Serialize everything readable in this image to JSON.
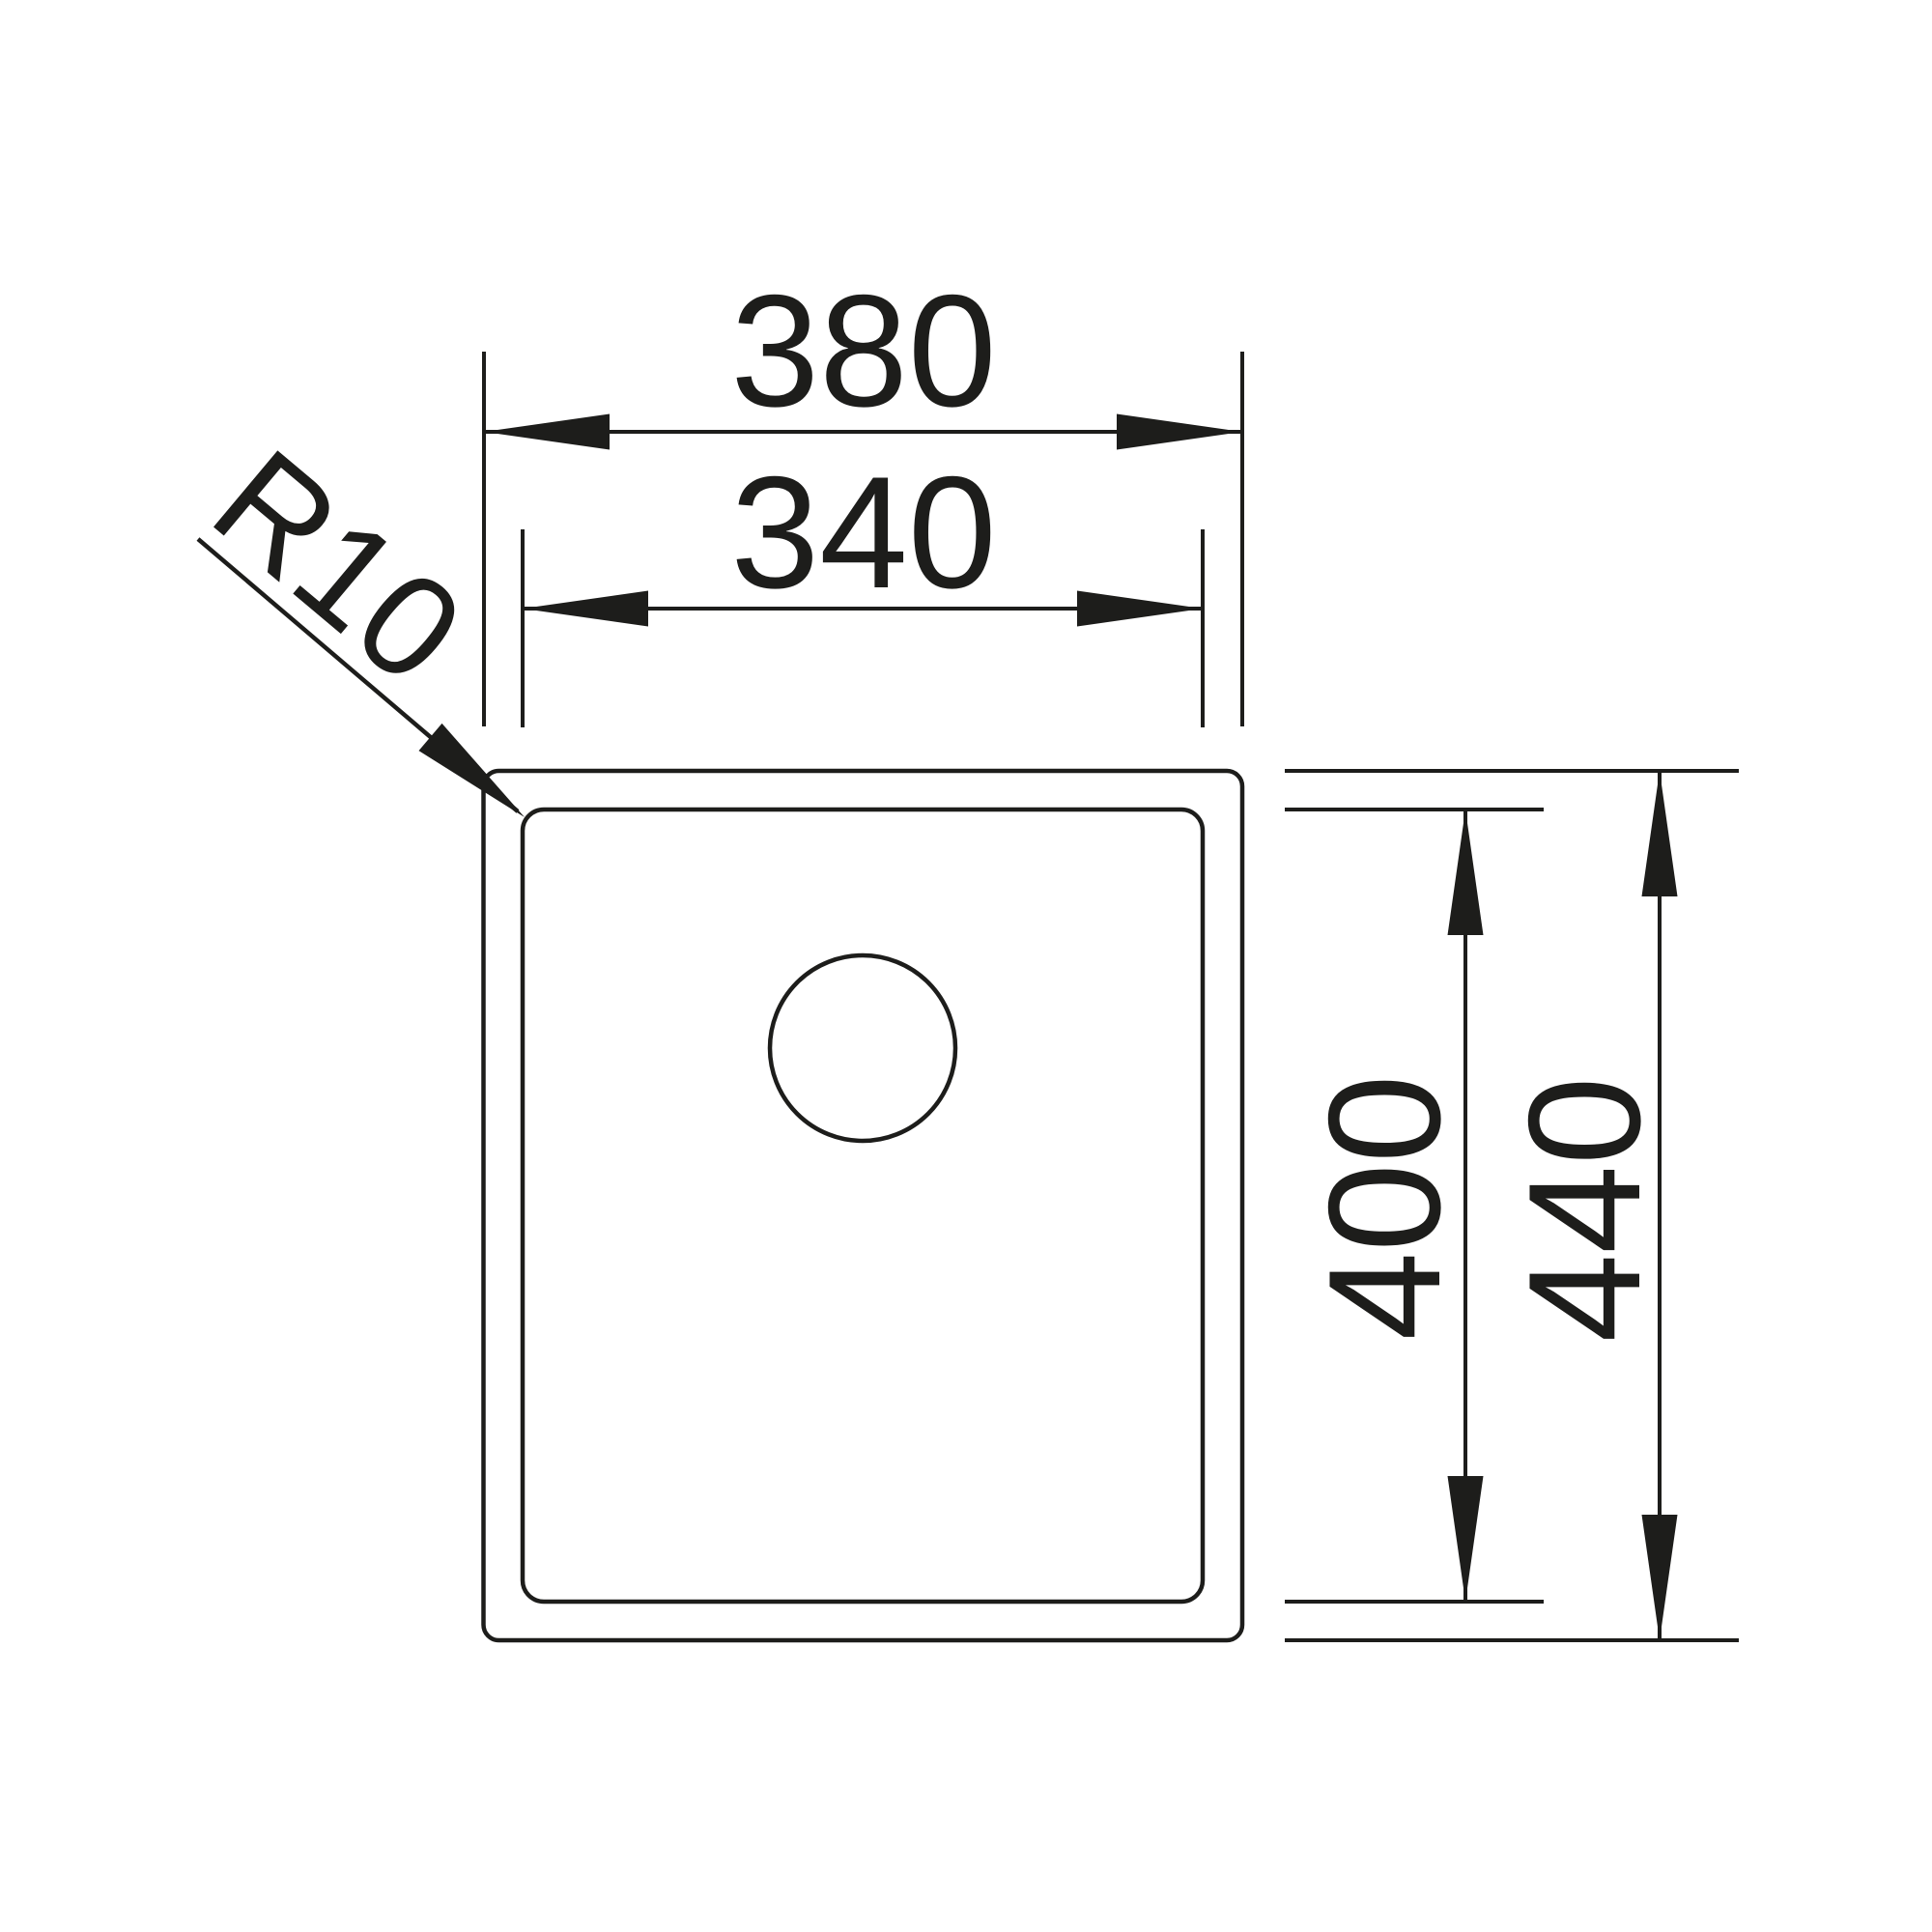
{
  "diagram": {
    "type": "sink-technical-drawing",
    "labels": {
      "outer_width": "380",
      "inner_width": "340",
      "inner_height": "400",
      "outer_height": "440",
      "corner_radius": "R10"
    },
    "colors": {
      "line": "#1d1d1b",
      "background": "#ffffff"
    }
  }
}
